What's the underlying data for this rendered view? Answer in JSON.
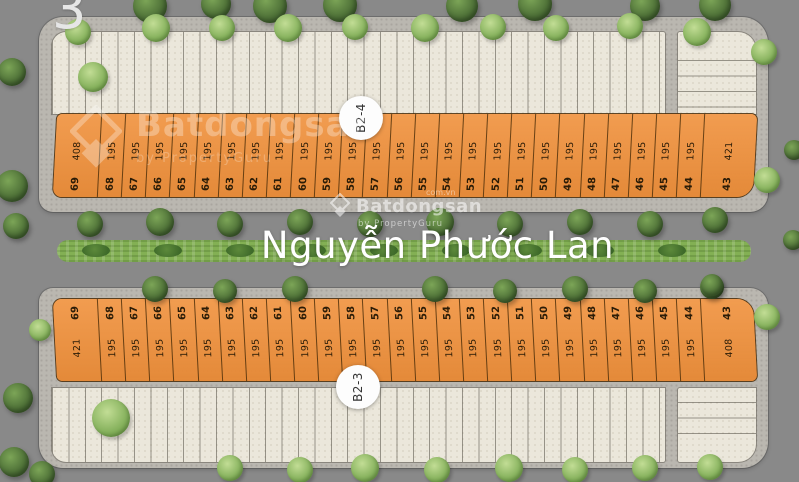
{
  "corner_label": "3",
  "street": {
    "name": "Nguyễn Phước Lan"
  },
  "watermark": {
    "brand": "Batdongsan",
    "byline": "by PropertyGuru",
    "domain": "com.vn"
  },
  "blocks": [
    {
      "label": "B2-4",
      "position": "top",
      "lots": [
        {
          "no": "69",
          "area": "408"
        },
        {
          "no": "68",
          "area": "195"
        },
        {
          "no": "67",
          "area": "195"
        },
        {
          "no": "66",
          "area": "195"
        },
        {
          "no": "65",
          "area": "195"
        },
        {
          "no": "64",
          "area": "195"
        },
        {
          "no": "63",
          "area": "195"
        },
        {
          "no": "62",
          "area": "195"
        },
        {
          "no": "61",
          "area": "195"
        },
        {
          "no": "60",
          "area": "195"
        },
        {
          "no": "59",
          "area": "195"
        },
        {
          "no": "58",
          "area": "195"
        },
        {
          "no": "57",
          "area": "195"
        },
        {
          "no": "56",
          "area": "195"
        },
        {
          "no": "55",
          "area": "195"
        },
        {
          "no": "54",
          "area": "195"
        },
        {
          "no": "53",
          "area": "195"
        },
        {
          "no": "52",
          "area": "195"
        },
        {
          "no": "51",
          "area": "195"
        },
        {
          "no": "50",
          "area": "195"
        },
        {
          "no": "49",
          "area": "195"
        },
        {
          "no": "48",
          "area": "195"
        },
        {
          "no": "47",
          "area": "195"
        },
        {
          "no": "46",
          "area": "195"
        },
        {
          "no": "45",
          "area": "195"
        },
        {
          "no": "44",
          "area": "195"
        },
        {
          "no": "43",
          "area": "421"
        }
      ]
    },
    {
      "label": "B2-3",
      "position": "bottom",
      "lots": [
        {
          "no": "69",
          "area": "421"
        },
        {
          "no": "68",
          "area": "195"
        },
        {
          "no": "67",
          "area": "195"
        },
        {
          "no": "66",
          "area": "195"
        },
        {
          "no": "65",
          "area": "195"
        },
        {
          "no": "64",
          "area": "195"
        },
        {
          "no": "63",
          "area": "195"
        },
        {
          "no": "62",
          "area": "195"
        },
        {
          "no": "61",
          "area": "195"
        },
        {
          "no": "60",
          "area": "195"
        },
        {
          "no": "59",
          "area": "195"
        },
        {
          "no": "58",
          "area": "195"
        },
        {
          "no": "57",
          "area": "195"
        },
        {
          "no": "56",
          "area": "195"
        },
        {
          "no": "55",
          "area": "195"
        },
        {
          "no": "54",
          "area": "195"
        },
        {
          "no": "53",
          "area": "195"
        },
        {
          "no": "52",
          "area": "195"
        },
        {
          "no": "51",
          "area": "195"
        },
        {
          "no": "50",
          "area": "195"
        },
        {
          "no": "49",
          "area": "195"
        },
        {
          "no": "48",
          "area": "195"
        },
        {
          "no": "47",
          "area": "195"
        },
        {
          "no": "46",
          "area": "195"
        },
        {
          "no": "45",
          "area": "195"
        },
        {
          "no": "44",
          "area": "195"
        },
        {
          "no": "43",
          "area": "408"
        }
      ]
    }
  ],
  "colors": {
    "lot_orange": "#f0913c",
    "road_gray": "#898989",
    "sidewalk_gray": "#bab7b0",
    "parcel_beige": "#ebe7db",
    "median_green": "#83b054",
    "street_text": "#ffffff"
  }
}
